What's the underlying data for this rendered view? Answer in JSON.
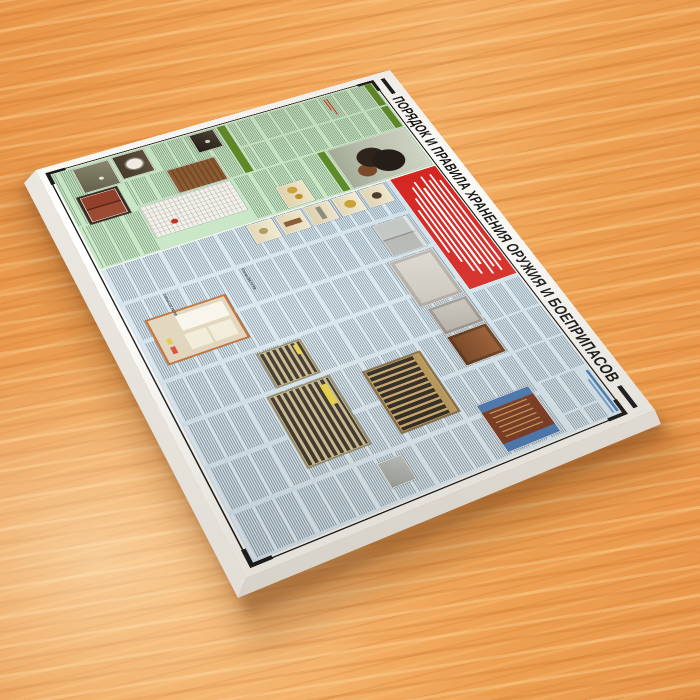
{
  "scene": {
    "surface": "wood-table"
  },
  "poster": {
    "title": "ПОРЯДОК И ПРАВИЛА ХРАНЕНИЯ ОРУЖИЯ И БОЕПРИПАСОВ",
    "legible_text": {
      "article_1": "Статья 224 УК РФ",
      "article_2": "Статья 222 УК РФ"
    },
    "colors": {
      "board": "#f7f5f0",
      "frame": "#1a1a1a",
      "title-text": "#141414",
      "green-bg": "#c9e7c6",
      "green-header": "#5f8a28",
      "red-block": "#d42520",
      "blue-bg": "#cfdfe8",
      "caption-blue": "#4a7fb5",
      "accent-red": "#c43322",
      "wood-mid": "#f0a558"
    },
    "sections": {
      "green": {
        "photos": [
          "guard-dog",
          "door-peephole",
          "hardware-detail",
          "slatted-shutters",
          "floor-plan",
          "round-vent-window",
          "wall-safe",
          "metal-cabinet-brown"
        ]
      },
      "red_notice": {
        "lines": [
          200,
          238,
          214,
          240,
          188,
          226,
          206,
          156,
          104
        ]
      },
      "blue": {
        "photos": [
          "hardware-item-1",
          "hardware-item-2",
          "hardware-item-3",
          "hardware-item-4",
          "hardware-item-5",
          "steel-double-cabinet",
          "metal-door-light",
          "metal-door-gray",
          "metal-door-brown",
          "gun-cabinet-open",
          "gun-rack-rifles",
          "wall-plate",
          "ammo-shelf",
          "ammo-box",
          "documents-licenses"
        ]
      }
    }
  }
}
